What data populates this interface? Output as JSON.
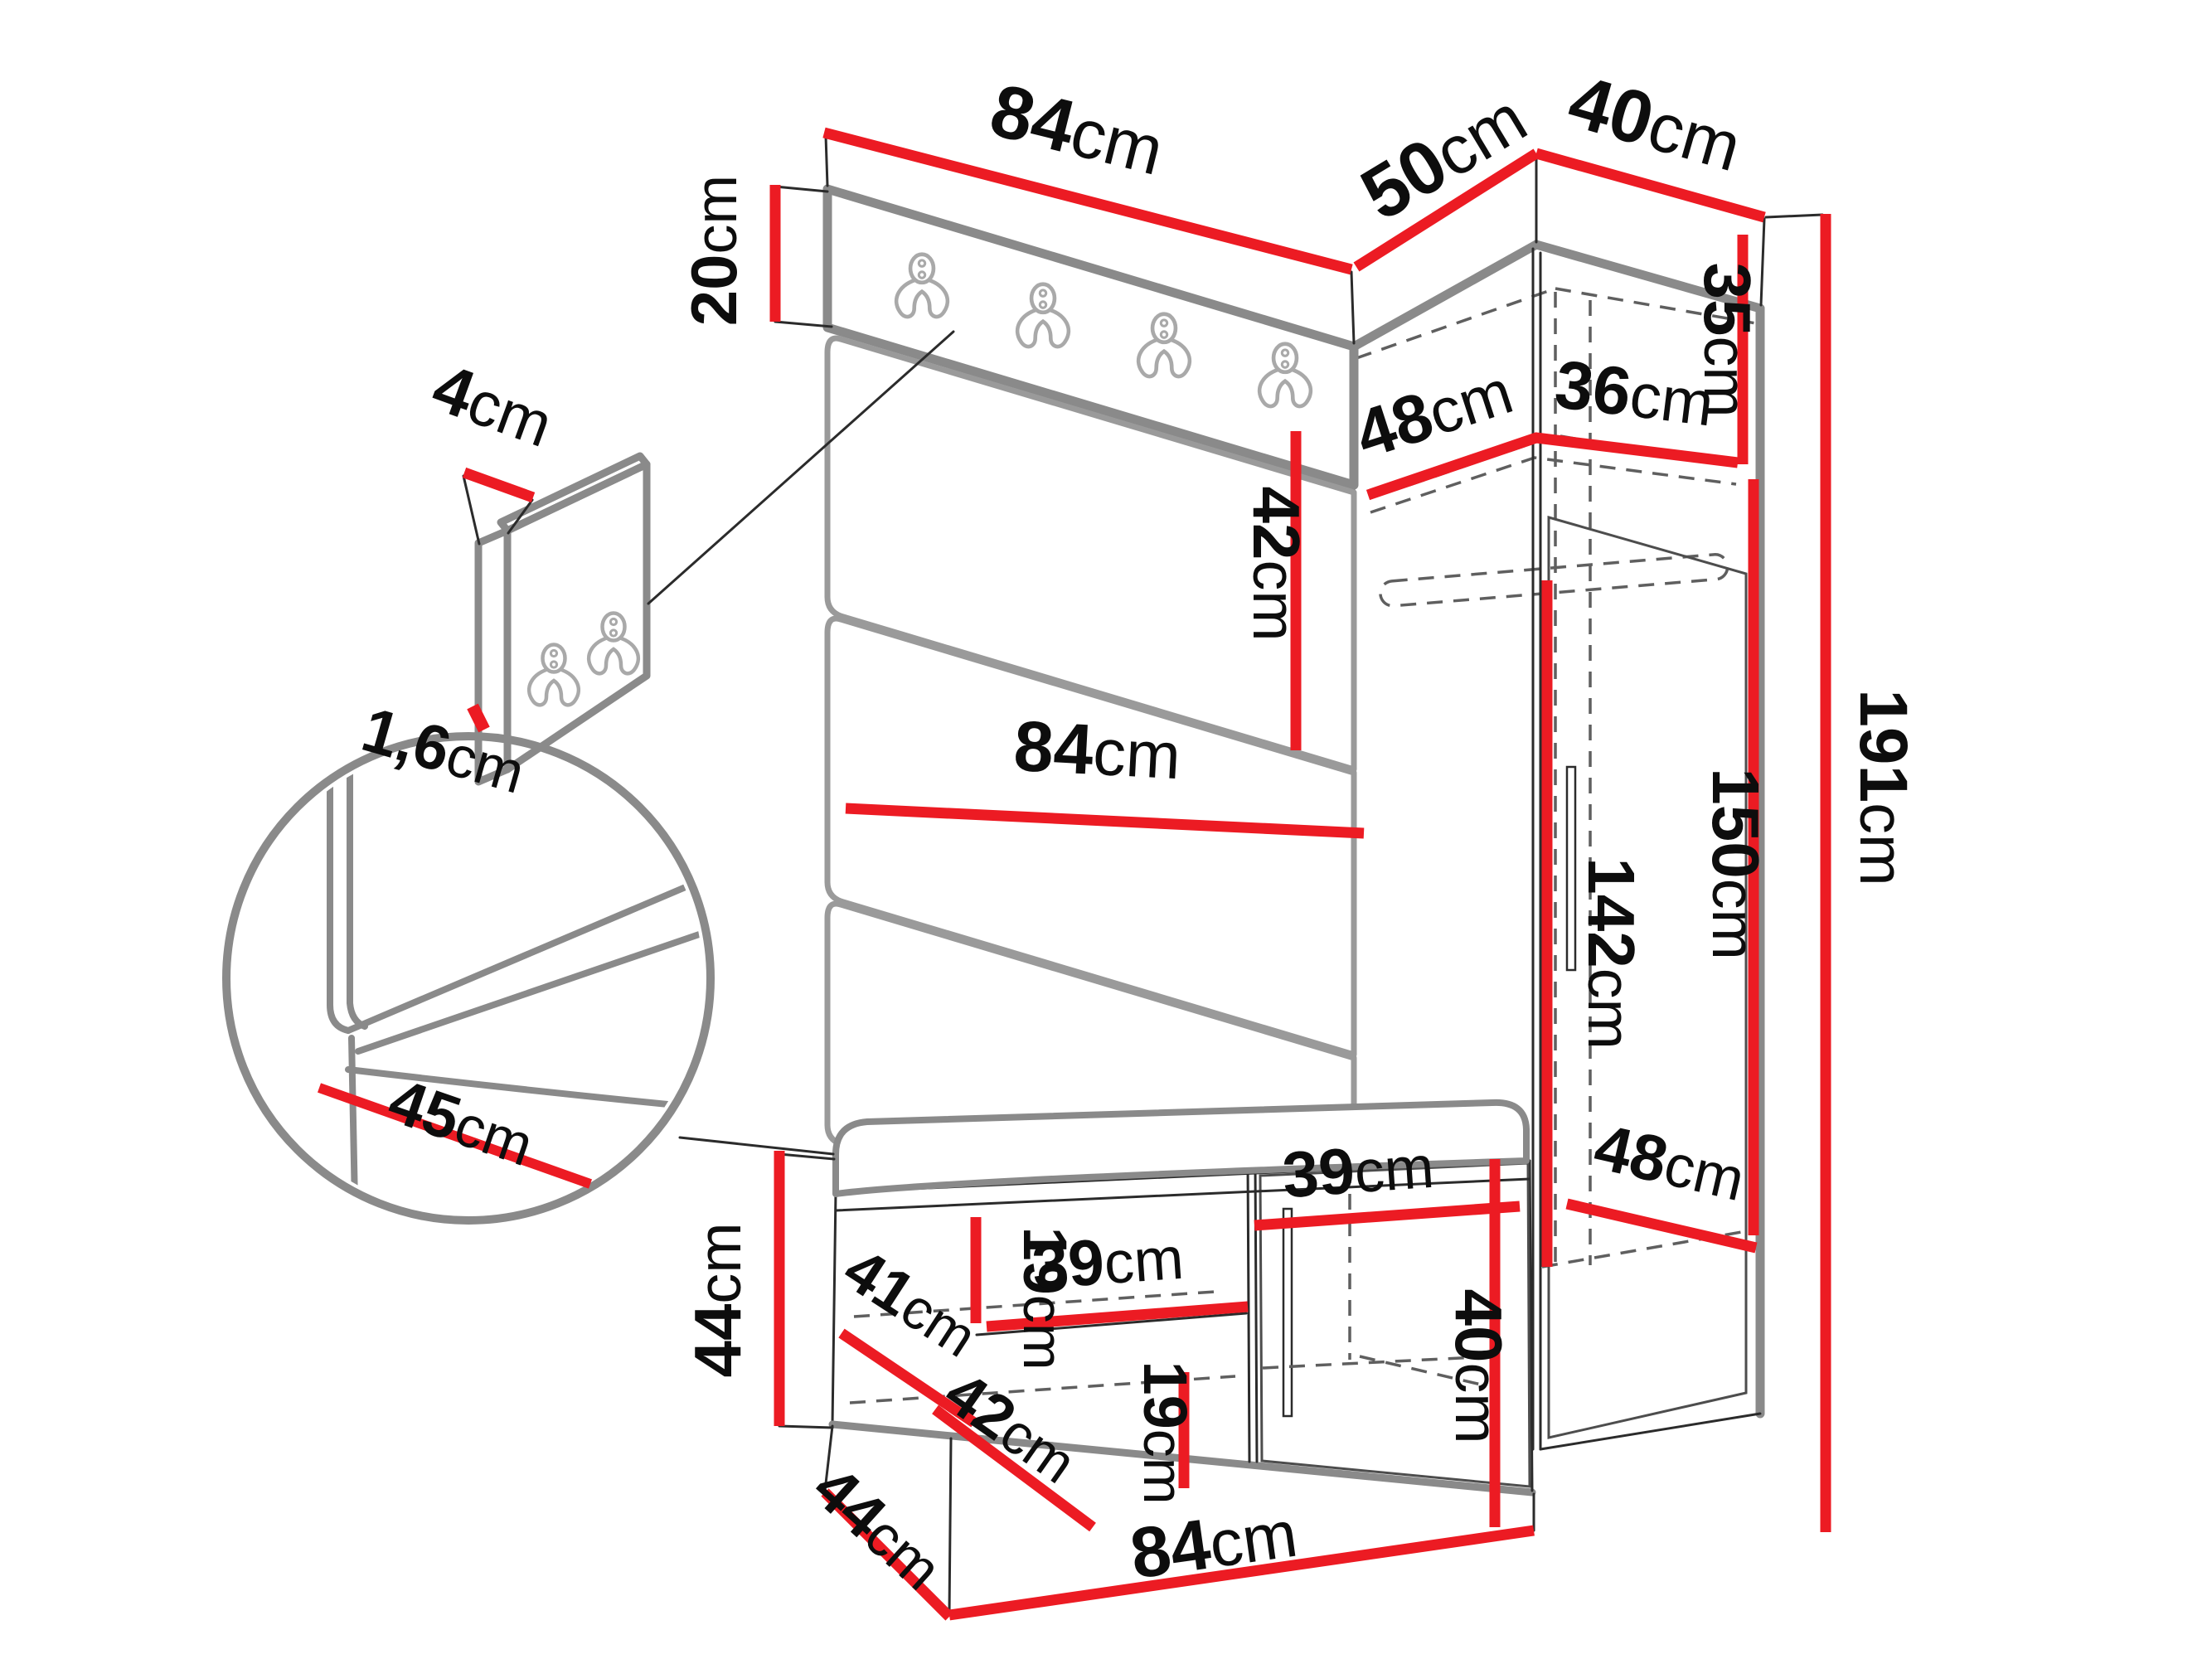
{
  "unit": "cm",
  "colors": {
    "dimension_line": "#ec1b23",
    "outline_thick": "#8a8a8a",
    "outline_thin": "#2b2b2b",
    "hidden_edge": "#5f5f5f",
    "text": "#0d0d0d",
    "background": "#ffffff"
  },
  "icons": {
    "coat_hook": "double-coat-hook-icon",
    "detail_magnifier": "detail-circle-zoom"
  },
  "labels": {
    "top_width": {
      "value": "84",
      "unit": "cm"
    },
    "corner_left_depth": {
      "value": "50",
      "unit": "cm"
    },
    "corner_right_width": {
      "value": "40",
      "unit": "cm"
    },
    "hook_strip_height": {
      "value": "20",
      "unit": "cm"
    },
    "small_panel_width": {
      "value": "4",
      "unit": "cm"
    },
    "small_panel_thickness": {
      "value": "1,6",
      "unit": "cm"
    },
    "cushion_height": {
      "value": "42",
      "unit": "cm"
    },
    "panel_width": {
      "value": "84",
      "unit": "cm"
    },
    "corner_inner_left": {
      "value": "48",
      "unit": "cm"
    },
    "corner_inner_right": {
      "value": "36",
      "unit": "cm"
    },
    "corner_shelf_height": {
      "value": "35",
      "unit": "cm"
    },
    "total_height": {
      "value": "191",
      "unit": "cm"
    },
    "door_height": {
      "value": "150",
      "unit": "cm"
    },
    "interior_height": {
      "value": "142",
      "unit": "cm"
    },
    "seat_depth_detail": {
      "value": "45",
      "unit": "cm"
    },
    "bench_height": {
      "value": "44",
      "unit": "cm"
    },
    "bench_shelf_depth": {
      "value": "41",
      "unit": "cm"
    },
    "shelf_gap_upper": {
      "value": "19",
      "unit": "cm"
    },
    "bench_shelf_width": {
      "value": "39",
      "unit": "cm"
    },
    "bench_lower_depth": {
      "value": "42",
      "unit": "cm"
    },
    "shelf_gap_lower": {
      "value": "19",
      "unit": "cm"
    },
    "bench_depth": {
      "value": "44",
      "unit": "cm"
    },
    "bench_width": {
      "value": "84",
      "unit": "cm"
    },
    "door_compartment_width": {
      "value": "39",
      "unit": "cm"
    },
    "door_compartment_height": {
      "value": "40",
      "unit": "cm"
    },
    "wardrobe_inner_depth": {
      "value": "48",
      "unit": "cm"
    }
  }
}
